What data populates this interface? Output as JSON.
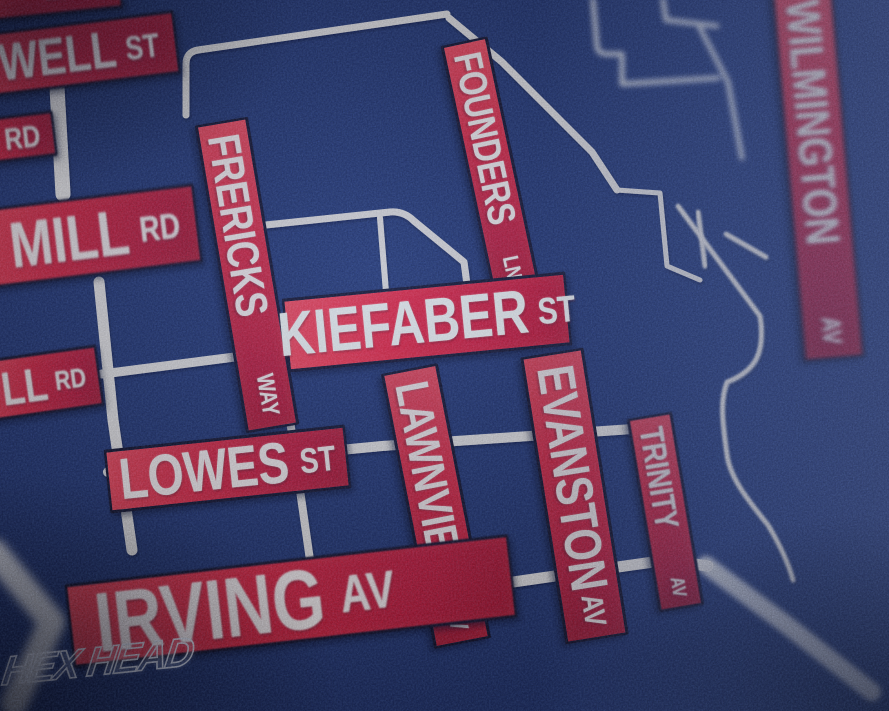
{
  "art": {
    "watermark": "HEX HEAD",
    "colors": {
      "background_navy": "#1d2b58",
      "sign_red": "#cf1422",
      "sign_text_cream": "#f7e9dc",
      "road_white": "#e9e2d4",
      "outline_black": "#0d0812"
    },
    "streets": [
      {
        "name": "E",
        "suffix": "ST"
      },
      {
        "name": "WELL",
        "suffix": "ST"
      },
      {
        "name": "",
        "suffix": "RD"
      },
      {
        "name": "MILL",
        "suffix": "RD"
      },
      {
        "name": "LL",
        "suffix": "RD"
      },
      {
        "name": "FRERICKS",
        "suffix": "WAY"
      },
      {
        "name": "KIEFABER",
        "suffix": "ST"
      },
      {
        "name": "FOUNDERS",
        "suffix": "LN"
      },
      {
        "name": "EVANSTON",
        "suffix": "AV"
      },
      {
        "name": "LAWNVIEW",
        "suffix": "AV"
      },
      {
        "name": "TRINITY",
        "suffix": "AV"
      },
      {
        "name": "WILMINGTON",
        "suffix": "AV"
      },
      {
        "name": "LOWES",
        "suffix": "ST"
      },
      {
        "name": "IRVING",
        "suffix": "AV"
      }
    ]
  }
}
